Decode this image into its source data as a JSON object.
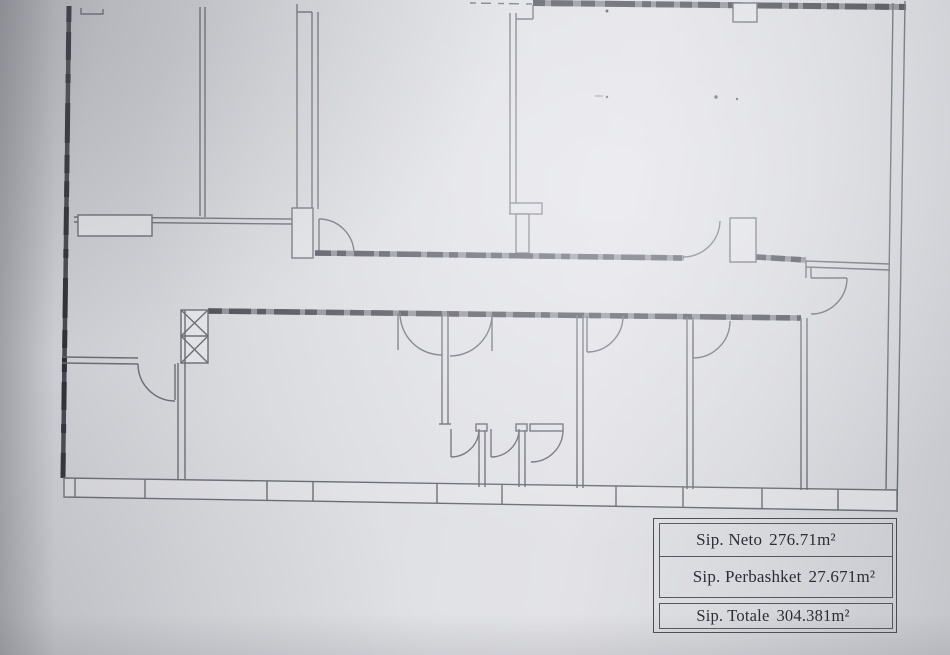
{
  "document": {
    "kind": "scanned architectural floor plan"
  },
  "area_table": {
    "rows": [
      {
        "label": "Sip. Neto",
        "value": "276.71m²"
      },
      {
        "label": "Sip. Perbashket",
        "value": "27.671m²"
      },
      {
        "label": "Sip. Totale",
        "value": "304.381m²"
      }
    ]
  },
  "colors": {
    "paper": "#dcdde1",
    "line": "#6a6c74",
    "heavy_wall": "#4b4c53",
    "text": "#2c2d35"
  }
}
